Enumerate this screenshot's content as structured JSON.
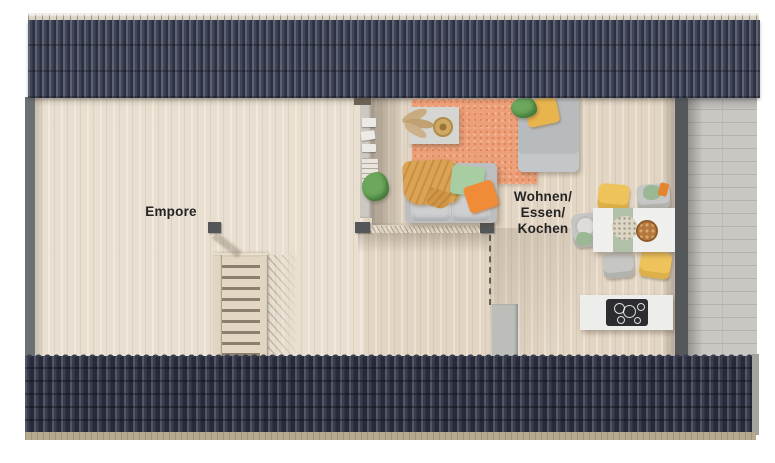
{
  "plan": {
    "type": "apartment-floor-plan-top-view",
    "rooms": [
      {
        "id": "empore",
        "label": "Empore"
      },
      {
        "id": "wohnen-essen-kochen",
        "label_lines": [
          "Wohnen/",
          "Essen/",
          "Kochen"
        ]
      }
    ],
    "features": [
      "staircase",
      "stair-railing",
      "gallery-railing",
      "divider-wall-with-bookshelf",
      "sofa-with-pillows",
      "coffee-table",
      "daybed",
      "rug",
      "dining-table-with-four-chairs",
      "kitchen-island-with-cooktop",
      "roof-surfaces-top-and-bottom",
      "exterior-brick-strip"
    ],
    "colors": {
      "roof_navy": "#40455a",
      "roof_navy_dark": "#383d50",
      "ridge_beige": "#dcd5c7",
      "eave_tan": "#b5a98e",
      "floor_empore": "#e8dfd0",
      "floor_living": "#e2d5c3",
      "wall_gray": "#54585b",
      "brick_gray": "#c9c7c2",
      "rug_coral": "#ec9f78",
      "sofa_gray": "#bcbebf",
      "blanket_ochre": "#dba354",
      "pillow_sage": "#a9cda2",
      "pillow_orange": "#f08c38",
      "chair_yellow": "#efc35b",
      "runner_sage": "#b1c1a9",
      "cooktop_black": "#2b2d30",
      "label_text": "#242424"
    }
  }
}
